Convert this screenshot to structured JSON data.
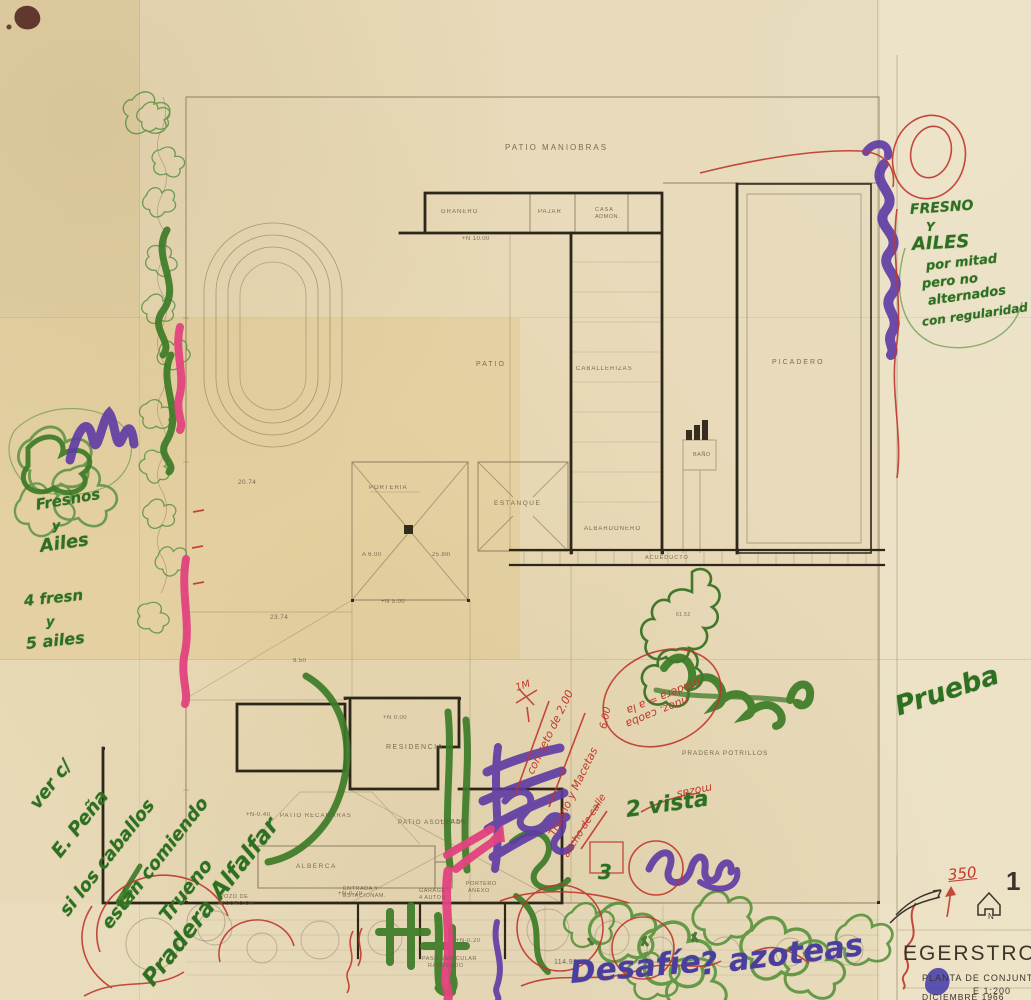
{
  "title_block": {
    "project": "EGERSTROM",
    "drawing": "PLANTA DE CONJUNTO",
    "scale": "E 1:200",
    "date": "DICIEMBRE 1966",
    "sheet_number": "1",
    "north_label": "N"
  },
  "plan_labels": [
    {
      "text": "PATIO  MANIOBRAS",
      "x": 505,
      "y": 143,
      "size": 8,
      "ls": 2
    },
    {
      "text": "GRANERO",
      "x": 441,
      "y": 209,
      "size": 6,
      "ls": 1
    },
    {
      "text": "PAJAR",
      "x": 538,
      "y": 209,
      "size": 6,
      "ls": 1
    },
    {
      "text": "CASA",
      "x": 595,
      "y": 207,
      "size": 5.5,
      "ls": 1
    },
    {
      "text": "ADMON.",
      "x": 595,
      "y": 214,
      "size": 5.5,
      "ls": 0.5
    },
    {
      "text": "PATIO",
      "x": 476,
      "y": 361,
      "size": 7,
      "ls": 2
    },
    {
      "text": "CABALLERIZAS",
      "x": 576,
      "y": 366,
      "size": 6,
      "ls": 1
    },
    {
      "text": "PICADERO",
      "x": 772,
      "y": 359,
      "size": 7,
      "ls": 2
    },
    {
      "text": "PORTERIA",
      "x": 369,
      "y": 485,
      "size": 6,
      "ls": 1
    },
    {
      "text": "ESTANQUE",
      "x": 494,
      "y": 500,
      "size": 6.5,
      "ls": 1.5
    },
    {
      "text": "ALBARDONERO",
      "x": 584,
      "y": 526,
      "size": 6,
      "ls": 1
    },
    {
      "text": "ACUEDUCTO",
      "x": 645,
      "y": 555,
      "size": 5.5,
      "ls": 1
    },
    {
      "text": "BAÑO",
      "x": 693,
      "y": 452,
      "size": 5.5,
      "ls": 0.5
    },
    {
      "text": "RESIDENCIA",
      "x": 386,
      "y": 744,
      "size": 7,
      "ls": 1.5
    },
    {
      "text": "PATIO  ASOLEADO",
      "x": 398,
      "y": 819,
      "size": 6.5,
      "ls": 1
    },
    {
      "text": "PRADERA  POTRILLOS",
      "x": 682,
      "y": 750,
      "size": 6.5,
      "ls": 1
    },
    {
      "text": "PATIO  RECAMARAS",
      "x": 280,
      "y": 813,
      "size": 6,
      "ls": 1
    },
    {
      "text": "ALBERCA",
      "x": 296,
      "y": 863,
      "size": 6.5,
      "ls": 1.5
    },
    {
      "text": "POZO DE",
      "x": 220,
      "y": 894,
      "size": 5.5,
      "ls": 0.5
    },
    {
      "text": "ABSORCION",
      "x": 217,
      "y": 901,
      "size": 5.5,
      "ls": 0.5
    },
    {
      "text": "ENTRADA Y",
      "x": 343,
      "y": 886,
      "size": 5.5,
      "ls": 0.5
    },
    {
      "text": "ESTACIONAM.",
      "x": 343,
      "y": 893,
      "size": 5.5,
      "ls": 0.5
    },
    {
      "text": "GARAGE",
      "x": 419,
      "y": 888,
      "size": 5.5,
      "ls": 0.5
    },
    {
      "text": "4 AUTOS",
      "x": 419,
      "y": 895,
      "size": 5.5,
      "ls": 0.5
    },
    {
      "text": "PORTERO",
      "x": 466,
      "y": 881,
      "size": 5.5,
      "ls": 0.5
    },
    {
      "text": "ANEXO",
      "x": 468,
      "y": 888,
      "size": 5.5,
      "ls": 0.5
    },
    {
      "text": "PASO VEHICULAR",
      "x": 422,
      "y": 956,
      "size": 5.5,
      "ls": 0.5
    },
    {
      "text": "RAMPEADO",
      "x": 428,
      "y": 963,
      "size": 5.5,
      "ls": 0.5
    }
  ],
  "elevation_marks": [
    {
      "text": "+N 10.00",
      "x": 462,
      "y": 236,
      "size": 6
    },
    {
      "text": "+N 5.00",
      "x": 381,
      "y": 599,
      "size": 6
    },
    {
      "text": "+N 0.00",
      "x": 383,
      "y": 715,
      "size": 6
    },
    {
      "text": "+N-0.50",
      "x": 440,
      "y": 819,
      "size": 6
    },
    {
      "text": "+N-0.20",
      "x": 456,
      "y": 938,
      "size": 6
    },
    {
      "text": "+N-0.20",
      "x": 338,
      "y": 891,
      "size": 6
    },
    {
      "text": "+N-0.40",
      "x": 246,
      "y": 812,
      "size": 6
    },
    {
      "text": "25.8m",
      "x": 432,
      "y": 552,
      "size": 6
    },
    {
      "text": "A 6.00",
      "x": 362,
      "y": 552,
      "size": 6
    },
    {
      "text": "20.74",
      "x": 238,
      "y": 479,
      "size": 6.5
    },
    {
      "text": "23.74",
      "x": 270,
      "y": 614,
      "size": 6.5
    },
    {
      "text": "9.50",
      "x": 293,
      "y": 658,
      "size": 6
    },
    {
      "text": "61.52",
      "x": 676,
      "y": 612,
      "size": 5
    },
    {
      "text": "114.92",
      "x": 554,
      "y": 959,
      "size": 7
    }
  ],
  "green_notes": [
    {
      "text": "FRESNO",
      "x": 910,
      "y": 203,
      "size": 14,
      "rot": -4
    },
    {
      "text": "Y",
      "x": 926,
      "y": 221,
      "size": 12,
      "rot": 0
    },
    {
      "text": "AILES",
      "x": 912,
      "y": 236,
      "size": 18,
      "rot": -3
    },
    {
      "text": "por mitad",
      "x": 926,
      "y": 260,
      "size": 13,
      "rot": -6
    },
    {
      "text": "pero no",
      "x": 922,
      "y": 278,
      "size": 13,
      "rot": -6
    },
    {
      "text": "alternados",
      "x": 928,
      "y": 295,
      "size": 13,
      "rot": -8
    },
    {
      "text": "con regularidad",
      "x": 922,
      "y": 316,
      "size": 12,
      "rot": -8
    },
    {
      "text": "Fresnos",
      "x": 36,
      "y": 498,
      "size": 15,
      "rot": -10
    },
    {
      "text": "y",
      "x": 52,
      "y": 520,
      "size": 13,
      "rot": -5
    },
    {
      "text": "Ailes",
      "x": 40,
      "y": 538,
      "size": 18,
      "rot": -8
    },
    {
      "text": "4 fresn",
      "x": 24,
      "y": 594,
      "size": 15,
      "rot": -6
    },
    {
      "text": "y",
      "x": 46,
      "y": 616,
      "size": 13,
      "rot": 0
    },
    {
      "text": "5 ailes",
      "x": 26,
      "y": 636,
      "size": 16,
      "rot": -6
    },
    {
      "text": "ver c/",
      "x": 34,
      "y": 798,
      "size": 18,
      "rot": -52
    },
    {
      "text": "E. Peña",
      "x": 56,
      "y": 846,
      "size": 19,
      "rot": -52
    },
    {
      "text": "si los caballos",
      "x": 64,
      "y": 905,
      "size": 18,
      "rot": -52
    },
    {
      "text": "están comiendo",
      "x": 106,
      "y": 918,
      "size": 18,
      "rot": -52
    },
    {
      "text": "Trueno",
      "x": 164,
      "y": 910,
      "size": 19,
      "rot": -52
    },
    {
      "text": "Pradera Alfalfar",
      "x": 148,
      "y": 972,
      "size": 23,
      "rot": -52
    },
    {
      "text": "2 vista",
      "x": 626,
      "y": 800,
      "size": 22,
      "rot": -8
    },
    {
      "text": "3",
      "x": 598,
      "y": 862,
      "size": 20,
      "rot": 0
    },
    {
      "text": "Prueba",
      "x": 896,
      "y": 694,
      "size": 27,
      "rot": -18
    }
  ],
  "red_notes": [
    {
      "text": "con seto de 2.00",
      "x": 530,
      "y": 768,
      "size": 11,
      "rot": -64
    },
    {
      "text": "Trueno y Macetas",
      "x": 552,
      "y": 830,
      "size": 11,
      "rot": -64
    },
    {
      "text": "madera = a la",
      "x": 700,
      "y": 676,
      "size": 11,
      "rot": 158
    },
    {
      "text": "nuez. caoba",
      "x": 688,
      "y": 694,
      "size": 11,
      "rot": 158
    },
    {
      "text": "6.00",
      "x": 604,
      "y": 724,
      "size": 10,
      "rot": -78
    },
    {
      "text": "ancho de calle",
      "x": 566,
      "y": 852,
      "size": 10,
      "rot": -58
    },
    {
      "text": "mozas",
      "x": 712,
      "y": 782,
      "size": 11,
      "rot": 168
    },
    {
      "text": "1M",
      "x": 516,
      "y": 684,
      "size": 10,
      "rot": -18
    },
    {
      "text": "350",
      "x": 948,
      "y": 868,
      "size": 15,
      "rot": -6,
      "u": true
    }
  ],
  "purple_notes": [
    {
      "text": "Desafíe",
      "x": 570,
      "y": 958,
      "size": 31,
      "rot": -5
    },
    {
      "text": "? azoteas",
      "x": 700,
      "y": 950,
      "size": 31,
      "rot": -7
    }
  ]
}
